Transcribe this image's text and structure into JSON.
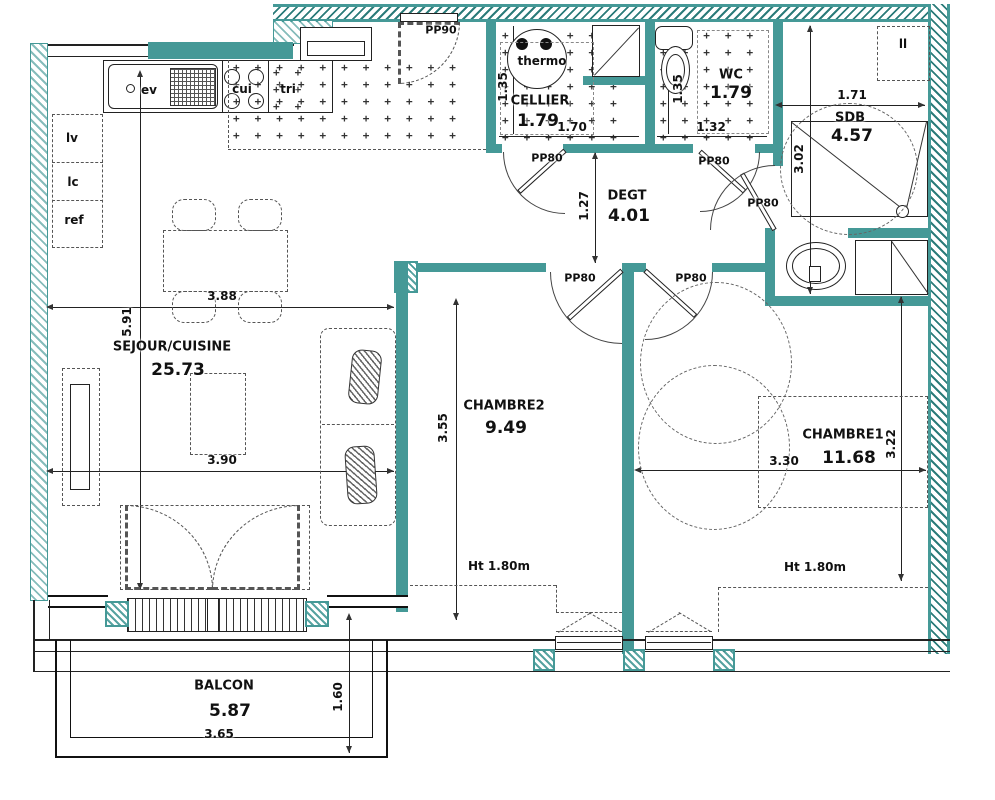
{
  "colors": {
    "wall_teal": "#459997",
    "line": "#222222"
  },
  "rooms": {
    "sejour": {
      "name": "SEJOUR/CUISINE",
      "area": "25.73"
    },
    "cellier": {
      "name": "CELLIER",
      "area": "1.79"
    },
    "wc": {
      "name": "WC",
      "area": "1.79"
    },
    "sdb": {
      "name": "SDB",
      "area": "4.57"
    },
    "degt": {
      "name": "DEGT",
      "area": "4.01"
    },
    "chambre2": {
      "name": "CHAMBRE2",
      "area": "9.49"
    },
    "chambre1": {
      "name": "CHAMBRE1",
      "area": "11.68"
    },
    "balcon": {
      "name": "BALCON",
      "area": "5.87"
    }
  },
  "dims": {
    "sejour_top": "3.88",
    "sejour_side": "5.91",
    "sejour_mid": "3.90",
    "cellier_side": "1.35",
    "cellier_bottom": "1.70",
    "wc_side": "1.35",
    "wc_bottom": "1.32",
    "degt_side": "1.27",
    "sdb_top": "1.71",
    "sdb_side": "3.02",
    "chambre2_side": "3.55",
    "chambre1_bottom": "3.30",
    "chambre1_side": "3.22",
    "balcon_bottom": "3.65",
    "balcon_side": "1.60",
    "chambre2_height": "Ht 1.80m",
    "chambre1_height": "Ht 1.80m"
  },
  "doors": {
    "entry": "PP90",
    "cellier": "PP80",
    "wc": "PP80",
    "sdb": "PP80",
    "chambre2": "PP80",
    "chambre1": "PP80"
  },
  "kitchen": {
    "sink": "ev",
    "cooktop": "cui",
    "worktop": "tri",
    "dishwasher": "lv",
    "laundry": "lc",
    "fridge": "ref"
  },
  "fixtures": {
    "water_heater": "thermo",
    "washing_machine": "ll"
  }
}
